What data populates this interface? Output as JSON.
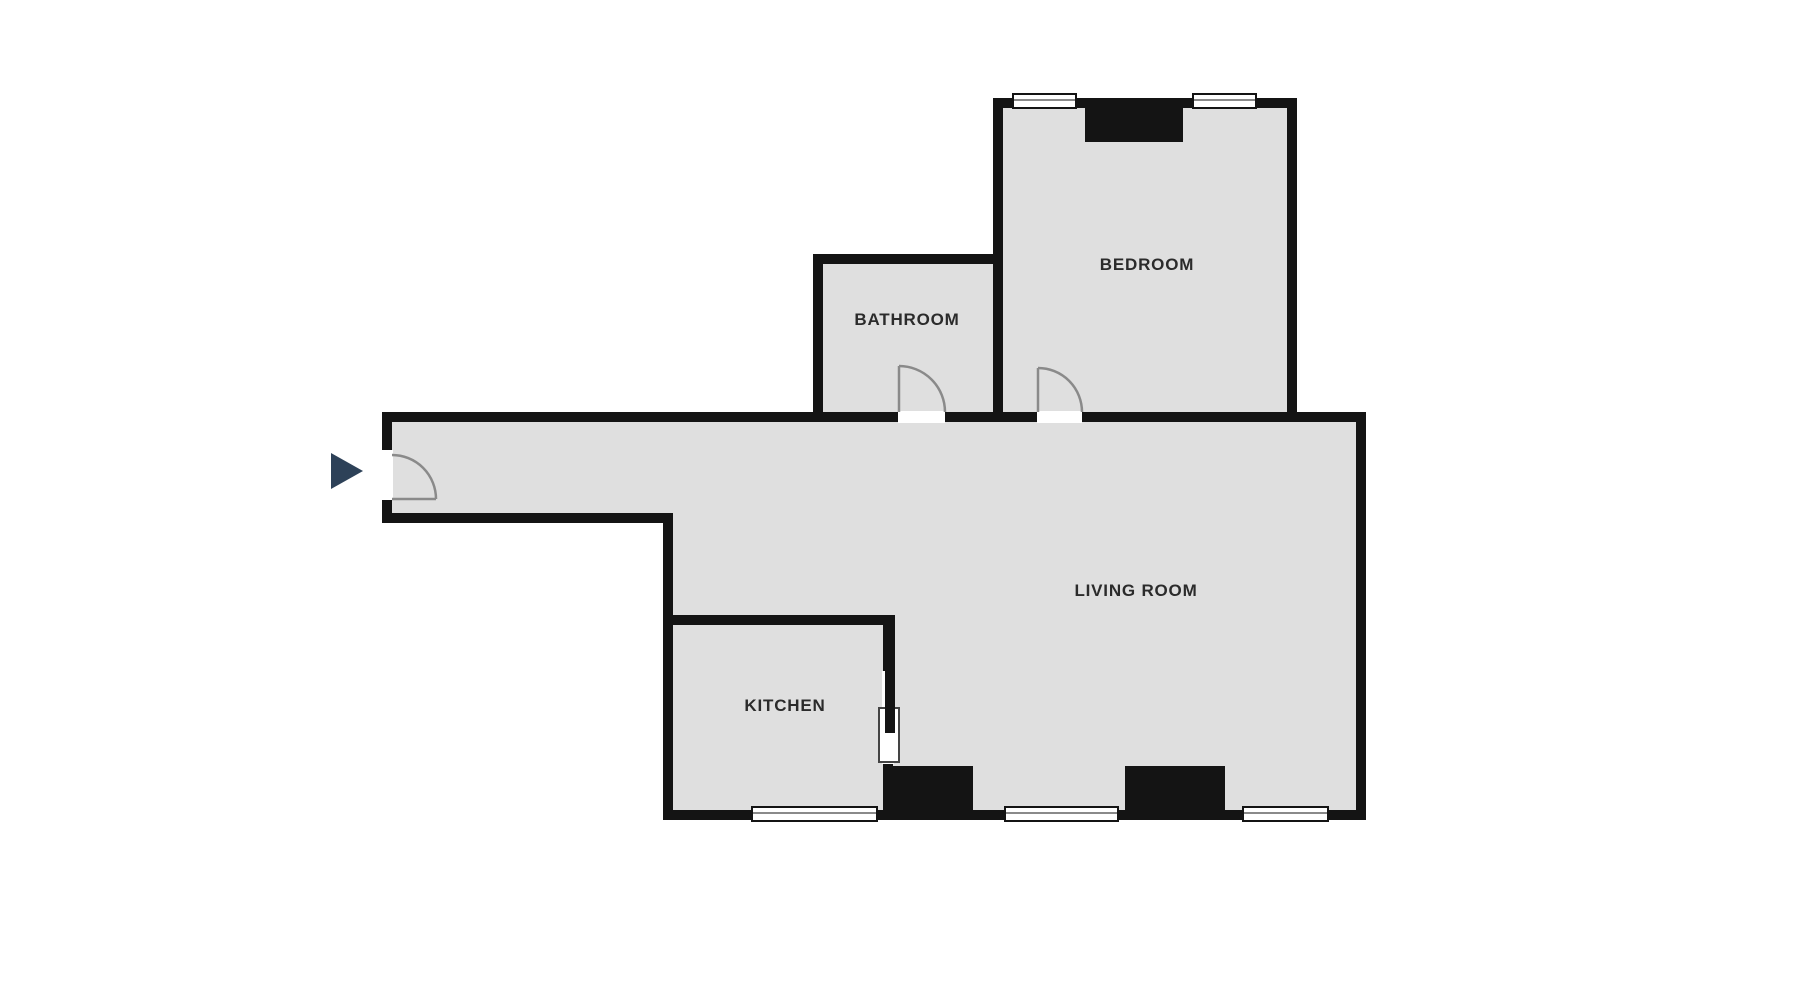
{
  "floorplan": {
    "rooms": {
      "bedroom": {
        "label": "BEDROOM"
      },
      "bathroom": {
        "label": "BATHROOM"
      },
      "living_room": {
        "label": "LIVING ROOM"
      },
      "kitchen": {
        "label": "KITCHEN"
      }
    },
    "icons": {
      "entrance_arrow": "right-pointing-triangle"
    },
    "colors": {
      "wall": "#141414",
      "floor": "#dfdfdf",
      "label": "#2b2b2b",
      "door": "#8a8a8a",
      "arrow": "#2d4158",
      "window_fill": "#ffffff",
      "background": "#ffffff"
    }
  }
}
